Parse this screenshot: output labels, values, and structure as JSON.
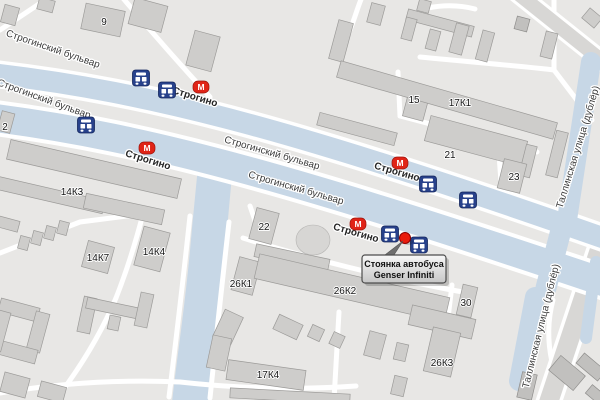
{
  "map": {
    "streets": {
      "boulevard": "Строгинский бульвар",
      "tallinskaya": "Таллинская улица (дублёр)"
    },
    "metro": {
      "name": "Строгино",
      "symbol": "М"
    },
    "buildings": {
      "b9": "9",
      "b2": "2",
      "b15": "15",
      "b17k1": "17К1",
      "b21": "21",
      "b23": "23",
      "b14k3": "14К3",
      "b14k7": "14К7",
      "b14k4": "14К4",
      "b22": "22",
      "b26k1": "26К1",
      "b26k2": "26К2",
      "b30": "30",
      "b26k3": "26К3",
      "b17k4": "17К4"
    },
    "callout": {
      "line1": "Стоянка автобуса",
      "line2": "Genser Infiniti"
    },
    "colors": {
      "land": "#e8e7e5",
      "road_blue": "#c7d7e6",
      "building": "#cecdcb",
      "metro_red": "#e02417",
      "bus_navy": "#27418b",
      "marker_red": "#ea1c0d"
    }
  }
}
